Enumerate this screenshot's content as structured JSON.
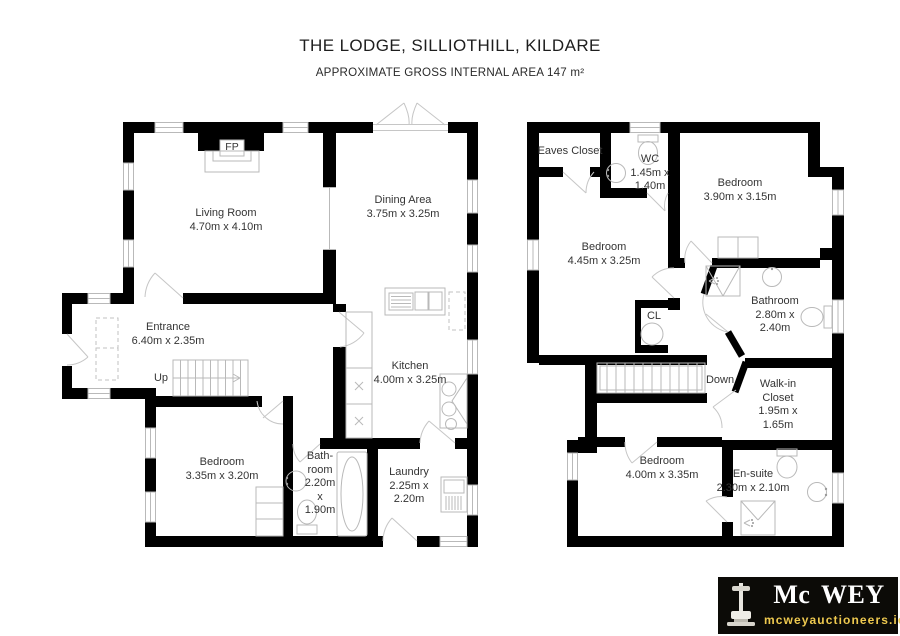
{
  "header": {
    "title": "THE LODGE, SILLIOTHILL, KILDARE",
    "subtitle": "APPROXIMATE GROSS INTERNAL AREA 147 m²"
  },
  "ground_floor": {
    "fireplace_label": "FP",
    "stairs_label": "Up",
    "rooms": {
      "living_room": {
        "lines": [
          "Living Room",
          "4.70m x 4.10m"
        ]
      },
      "dining_area": {
        "lines": [
          "Dining Area",
          "3.75m x 3.25m"
        ]
      },
      "entrance": {
        "lines": [
          "Entrance",
          "6.40m x 2.35m"
        ]
      },
      "kitchen": {
        "lines": [
          "Kitchen",
          "4.00m x 3.25m"
        ]
      },
      "bedroom": {
        "lines": [
          "Bedroom",
          "3.35m x 3.20m"
        ]
      },
      "bathroom": {
        "lines": [
          "Bath-",
          "room",
          "2.20m",
          "x",
          "1.90m"
        ]
      },
      "laundry": {
        "lines": [
          "Laundry",
          "2.25m x",
          "2.20m"
        ]
      }
    }
  },
  "first_floor": {
    "stairs_label": "Down",
    "rooms": {
      "eaves_closet": {
        "lines": [
          "Eaves Closet"
        ]
      },
      "wc": {
        "lines": [
          "WC",
          "1.45m x",
          "1.40m"
        ]
      },
      "bedroom_front": {
        "lines": [
          "Bedroom",
          "3.90m x 3.15m"
        ]
      },
      "bedroom_middle": {
        "lines": [
          "Bedroom",
          "4.45m x 3.25m"
        ]
      },
      "closet": {
        "lines": [
          "CL"
        ]
      },
      "bathroom": {
        "lines": [
          "Bathroom",
          "2.80m x",
          "2.40m"
        ]
      },
      "walk_in_closet": {
        "lines": [
          "Walk-in",
          "Closet",
          "1.95m x",
          "1.65m"
        ]
      },
      "bedroom_rear": {
        "lines": [
          "Bedroom",
          "4.00m x 3.35m"
        ]
      },
      "en_suite": {
        "lines": [
          "En-suite",
          "2.30m x 2.10m"
        ]
      }
    }
  },
  "logo": {
    "brand": "Mc WEY",
    "website": "mcweyauctioneers.ie",
    "colors": {
      "background": "#0c0b07",
      "brand_text": "#ffffff",
      "website_text": "#eec94f"
    }
  },
  "colors": {
    "wall": "#000000",
    "fixture_line": "#b9b9b9",
    "label_text": "#343434"
  }
}
